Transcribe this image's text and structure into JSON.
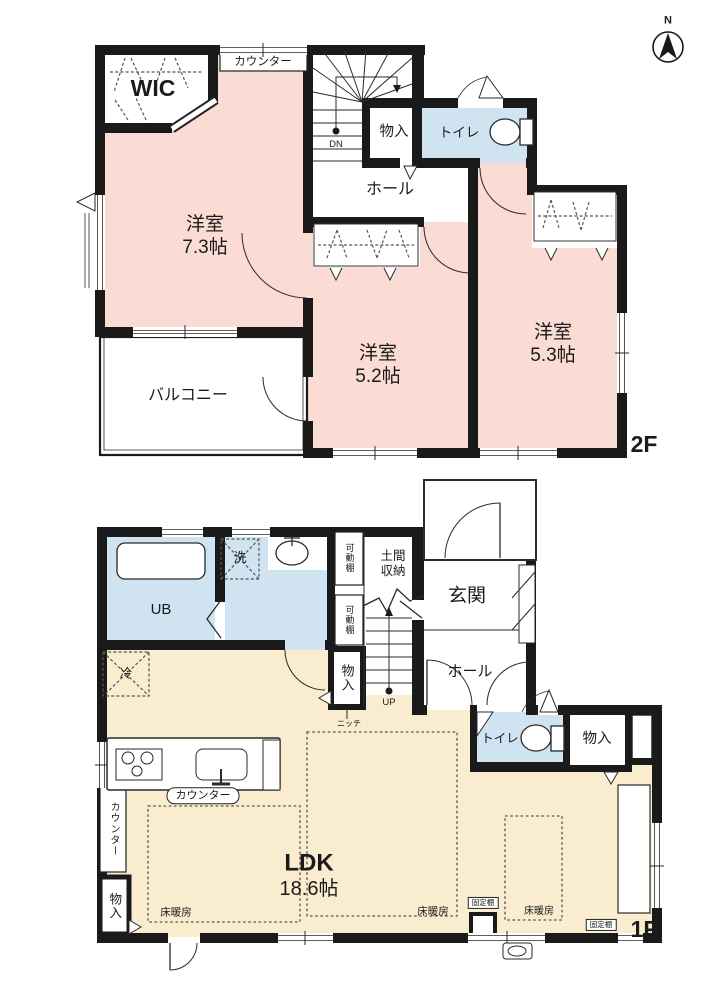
{
  "title": "2階建て住宅 間取り図",
  "compass": {
    "north": "N"
  },
  "colors": {
    "wall": "#1a1a1a",
    "pink": "#fbdcd4",
    "beige": "#faecce",
    "blue": "#cfe4f0"
  },
  "floor2": {
    "label": "2F",
    "wic": "WIC",
    "counter": "カウンター",
    "dn": "DN",
    "storage": "物入",
    "toilet": "トイレ",
    "hall": "ホール",
    "room_7_3": "洋室\n7.3帖",
    "room_5_2": "洋室\n5.2帖",
    "room_5_3": "洋室\n5.3帖",
    "balcony": "バルコニー"
  },
  "floor1": {
    "label": "1F",
    "ub": "UB",
    "wash": "洗",
    "shelf_movable_1": "可動棚",
    "shelf_movable_2": "可動棚",
    "doma_storage": "土間\n収納",
    "entrance": "玄関",
    "hall": "ホール",
    "storage_by_stairs": "物入",
    "niche": "ニッチ",
    "up": "UP",
    "fridge": "冷",
    "toilet": "トイレ",
    "storage_right": "物入",
    "counter_kitchen": "カウンター",
    "counter_wall": "カウンター",
    "storage_left": "物入",
    "ldk_title": "LDK",
    "ldk_size": "18.6帖",
    "floor_heating_1": "床暖房",
    "floor_heating_2": "床暖房",
    "floor_heating_3": "床暖房",
    "shelf_fixed_1": "固定棚",
    "shelf_fixed_2": "固定棚"
  }
}
